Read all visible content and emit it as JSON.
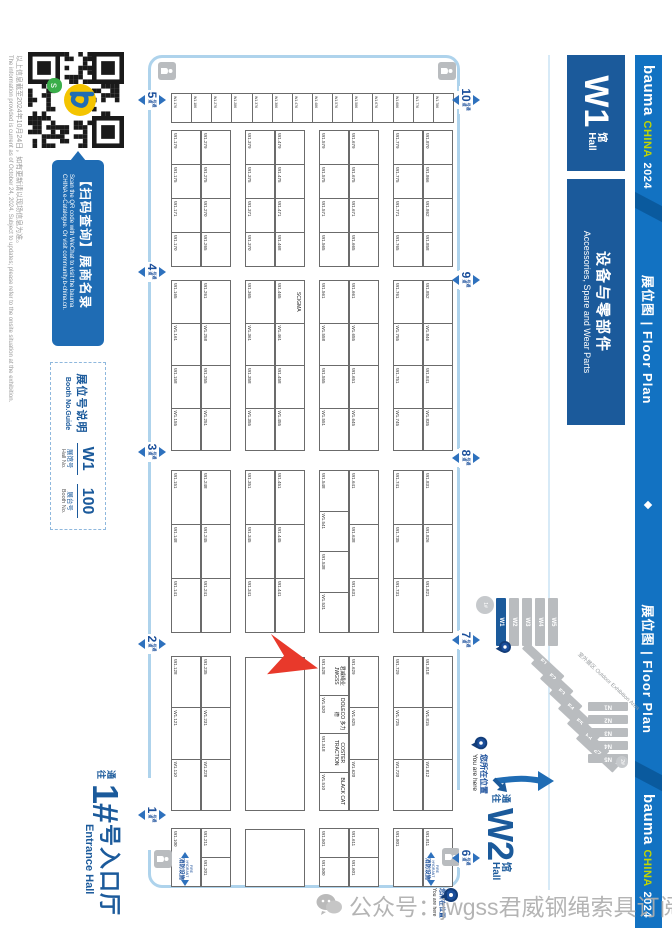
{
  "brand_bar": {
    "bauma": "bauma",
    "china": "CHINA",
    "year": "2024",
    "floor_plan_zh": "展位图",
    "floor_plan_sep": "|",
    "floor_plan_en": "Floor Plan"
  },
  "hall_bar": {
    "hall_code": "W1",
    "hall_zh": "馆",
    "hall_en": "Hall",
    "category_zh": "设备与零部件",
    "category_en": "Accessories, Spare and Wear Parts"
  },
  "qr_panel": {
    "banner_zh": "【扫码查询】展商名录",
    "banner_en_1": "Scan the QR code with WeChat to visit the bauma",
    "banner_en_2": "CHINA e-Catalogue. Or visit community.b-china.cn."
  },
  "booth_guide": {
    "title_zh": "展位号说明",
    "title_en": "Booth No.Guide",
    "hall_no": "W1",
    "booth_no": "100",
    "hall_label_zh": "展馆号",
    "hall_label_en": "Hall No.",
    "booth_label_zh": "展台号",
    "booth_label_en": "Booth No."
  },
  "disclaimer": {
    "zh": "以上信息截至2024年10月24日，如有更新请以现场信息为准。",
    "en": "The information provided is current as of October 24, 2024. Subject to updates; please refer to the onsite situation at the exhibition."
  },
  "entrance_hall": {
    "prefix_zh": "通往",
    "number": "1#",
    "name_zh": "号入口厅",
    "name_en": "Entrance Hall"
  },
  "w2_exit": {
    "prefix_zh": "通往",
    "code": "W2",
    "suffix_zh": "馆",
    "suffix_en": "Hall"
  },
  "you_are_here": {
    "zh": "您所在位置",
    "en": "You are here"
  },
  "minimap": {
    "w_halls": [
      "W1",
      "W2",
      "W3",
      "W4",
      "W5"
    ],
    "e_halls": [
      "E1",
      "E2",
      "E3",
      "E4",
      "E5",
      "E6",
      "E7"
    ],
    "n_halls": [
      "N1",
      "N2",
      "N3",
      "N4",
      "N5"
    ],
    "entrance1": "1#",
    "entrance2": "2#",
    "outdoor_zh": "室外展区",
    "outdoor_en": "Outdoor Exhibition Area"
  },
  "aisles": {
    "suffix_zh": "号通道",
    "top": [
      "10",
      "9",
      "8",
      "7",
      "6"
    ],
    "bottom": [
      "5",
      "4",
      "3",
      "2",
      "1"
    ]
  },
  "fire_marker": {
    "en": "FIRE HYDRANT",
    "zh": "消防设施"
  },
  "watermark": {
    "text": "公众号：jwgss君威钢绳索具订阅号"
  },
  "floor": {
    "prefix": "W1.",
    "left_column": [
      "786",
      "776",
      "686",
      "676",
      "586",
      "576",
      "486",
      "476",
      "386",
      "376",
      "286",
      "276",
      "186",
      "176"
    ],
    "rows": {
      "r8": [
        "870",
        "866",
        "862",
        "858",
        "|",
        "852",
        "846",
        "841",
        "835",
        "|",
        "831",
        "826",
        "821",
        "|",
        "818",
        "815",
        "812",
        "|",
        "811"
      ],
      "r7": [
        "779",
        "775",
        "771",
        "765",
        "|",
        "761",
        "755",
        "751",
        "745",
        "|",
        "741",
        "735",
        "731",
        "|",
        "729",
        "725",
        "720",
        "|",
        "801"
      ],
      "r6": [
        "679",
        "675",
        "671",
        "665",
        "|",
        "661",
        "655",
        "651",
        "645",
        "|",
        "641",
        "638",
        "631",
        "|",
        "629",
        "625",
        "620",
        "|",
        "611",
        "601"
      ],
      "r5": [
        "579",
        "575",
        "571",
        "565",
        "|",
        "561",
        "558",
        "555",
        "551",
        "|",
        "548",
        "541",
        "538",
        "531",
        "|",
        "528",
        "520",
        "518",
        "510",
        "|",
        "501",
        "500"
      ],
      "r4": [
        "479",
        "475",
        "471",
        "468",
        "|",
        "465",
        "461",
        "458",
        "455",
        "|",
        "451",
        "445",
        "441",
        "|",
        "~"
      ],
      "r3": [
        "379",
        "375",
        "371",
        "370",
        "|",
        "365",
        "361",
        "358",
        "355",
        "|",
        "351",
        "345",
        "341",
        "|",
        "~"
      ],
      "r2": [
        "279",
        "275",
        "270",
        "265",
        "|",
        "261",
        "258",
        "255",
        "251",
        "|",
        "248",
        "245",
        "241",
        "|",
        "235",
        "231",
        "228",
        "|",
        "211",
        "201"
      ],
      "r1": [
        "179",
        "175",
        "171",
        "170",
        "|",
        "165",
        "161",
        "158",
        "155",
        "|",
        "151",
        "148",
        "141",
        "|",
        "128",
        "121",
        "110",
        "|",
        "100"
      ]
    },
    "names": {
      "W1.528": "君威绳业 JWGSS",
      "W1.520": "DOLECO 多力德",
      "W1.518": "COSTER TRACTION",
      "W1.510": "BLACK CAT",
      "W1.465": "SCIGMA"
    }
  }
}
